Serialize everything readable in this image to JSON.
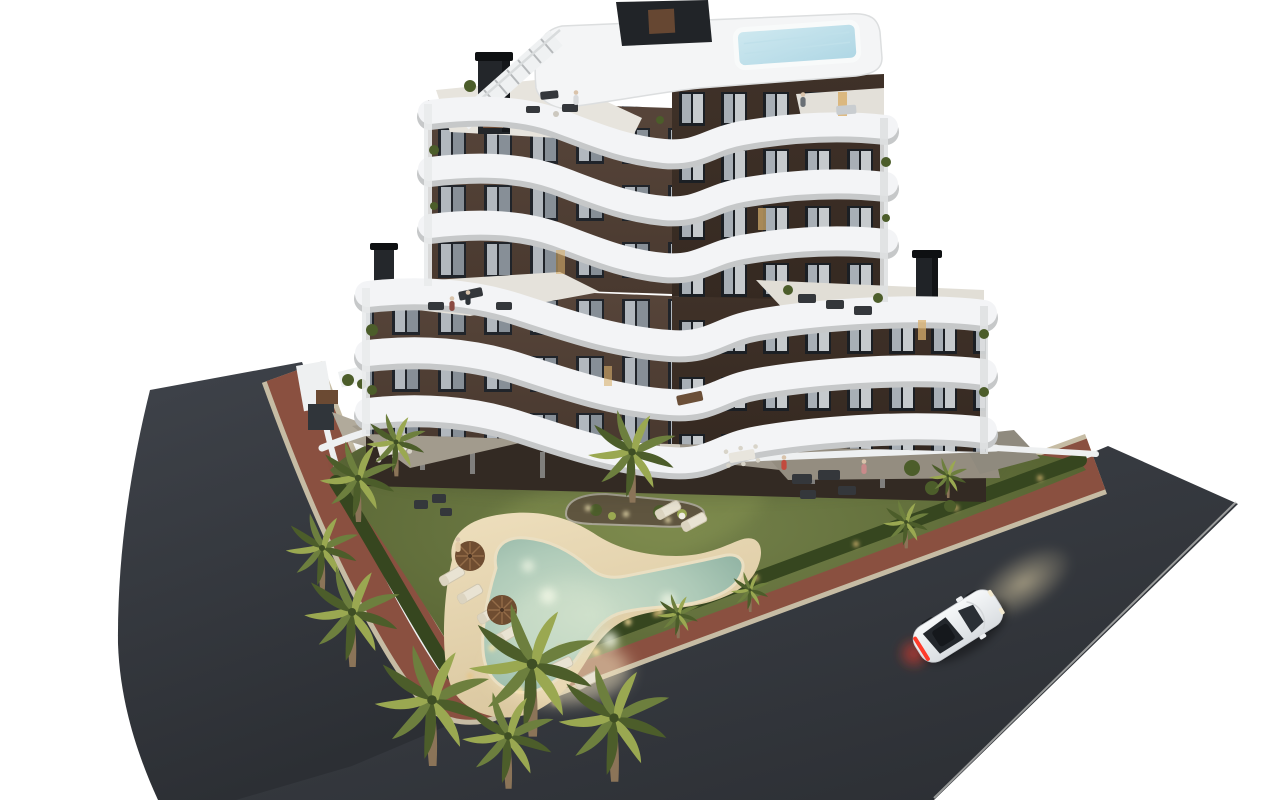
{
  "scene": {
    "description": "Aerial dusk 3D rendering of a modern six-storey apartment building with curved white balcony bands and a dark brown facade, rooftop terraces with a plunge pool, a landscaped communal garden with a lit free-form swimming pool, sand-coloured deck, palm trees and perimeter hedge, framed by a red clay footpath and dark asphalt streets with a white sports car driving past",
    "setting": "dusk",
    "style": "architectural visualization render",
    "background": "#ffffff"
  },
  "colors": {
    "bg": "#ffffff",
    "asphalt": "#3f434a",
    "asphalt_deep": "#2c2f34",
    "sidewalk": "#8a5040",
    "sidewalk_deep": "#73402f",
    "curb": "#c6bca4",
    "lawn": "#74814a",
    "lawn_deep": "#4f5c2c",
    "hedge": "#36461f",
    "sand": "#e7d7b2",
    "sand_glow": "#f5e6c2",
    "pool": "#aecab8",
    "pool_deep": "#86ab9c",
    "pool_light": "#cfe0cb",
    "band": "#f3f4f6",
    "band_shadow": "#c6c8c9",
    "facade_left": "#57453a",
    "facade_right": "#3f3128",
    "window_dark": "#20242a",
    "glass": "#b2b8be",
    "roof_deck": "#f4f5f6",
    "roof_pool": "#aed6e4",
    "patio": "#a29b8d",
    "wall": "#eef0f1",
    "trunk": "#8b7458",
    "frond": "#6d7f3e",
    "frond_light": "#9aa851",
    "frond_dark": "#4c5d2a",
    "furniture": "#34373b",
    "umbrella": "#6f4d31",
    "car_body": "#eef0f2",
    "taillight": "#ff3b2a",
    "headlight_beam": "#f1e0b2"
  },
  "objects": {
    "building": {
      "label": "apartment building",
      "floors_visible": 6,
      "balcony_bands": 6,
      "features": [
        "curved white balcony parapets",
        "dark brown facade",
        "rooftop plunge pool",
        "roof terraces",
        "external roof staircase",
        "chimneys",
        "podium terraces",
        "ground-floor patios"
      ]
    },
    "garden": {
      "label": "communal garden",
      "features": [
        "lawn",
        "free-form swimming pool",
        "sand-coloured pool deck",
        "island planter",
        "palm trees",
        "perimeter hedge",
        "sun loungers",
        "parasols",
        "garden lights"
      ]
    },
    "pool": {
      "shape": "free-form boomerang",
      "state": "lit at dusk",
      "loungers": 8,
      "parasols": 2
    },
    "roads": {
      "left_road": "asphalt street",
      "main_road": "asphalt street",
      "footpath": "red clay perimeter path",
      "curb": "light stone curb"
    },
    "car": {
      "label": "white sports car",
      "color": "white",
      "state": "driving, lights on",
      "direction": "up-right"
    },
    "people_count": 7,
    "palm_count": 13
  }
}
